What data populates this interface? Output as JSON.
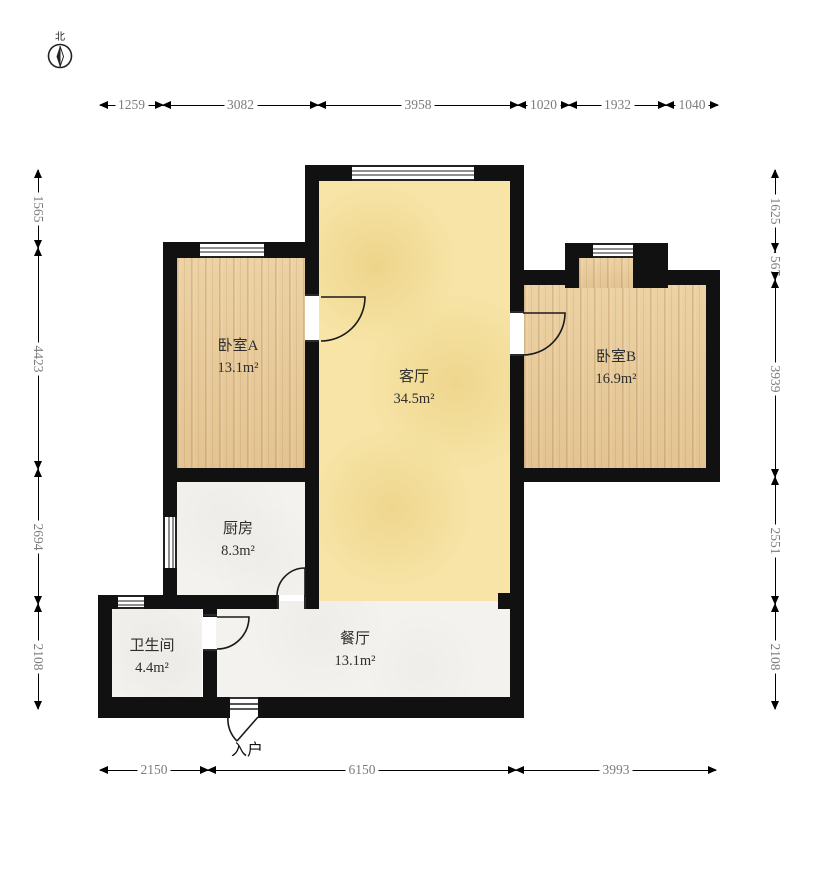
{
  "compass": {
    "north_label": "北"
  },
  "rooms": {
    "bedroomA": {
      "name": "卧室A",
      "area": "13.1m²"
    },
    "living": {
      "name": "客厅",
      "area": "34.5m²"
    },
    "bedroomB": {
      "name": "卧室B",
      "area": "16.9m²"
    },
    "kitchen": {
      "name": "厨房",
      "area": "8.3m²"
    },
    "bathroom": {
      "name": "卫生间",
      "area": "4.4m²"
    },
    "dining": {
      "name": "餐厅",
      "area": "13.1m²"
    }
  },
  "entry": {
    "label": "入户"
  },
  "dimensions_mm": {
    "top": [
      "1259",
      "3082",
      "3958",
      "1020",
      "1932",
      "1040"
    ],
    "bottom": [
      "2150",
      "6150",
      "3993"
    ],
    "left": [
      "1565",
      "4423",
      "2694",
      "2108"
    ],
    "right": [
      "1625",
      "567",
      "3939",
      "2551",
      "2108"
    ]
  },
  "colors": {
    "wall": "#111111",
    "wood_floor": "#e7cb9d",
    "living_floor": "#f7e4a6",
    "plain_floor": "#f3f2ee",
    "dimension_text": "#7c7c7c"
  }
}
